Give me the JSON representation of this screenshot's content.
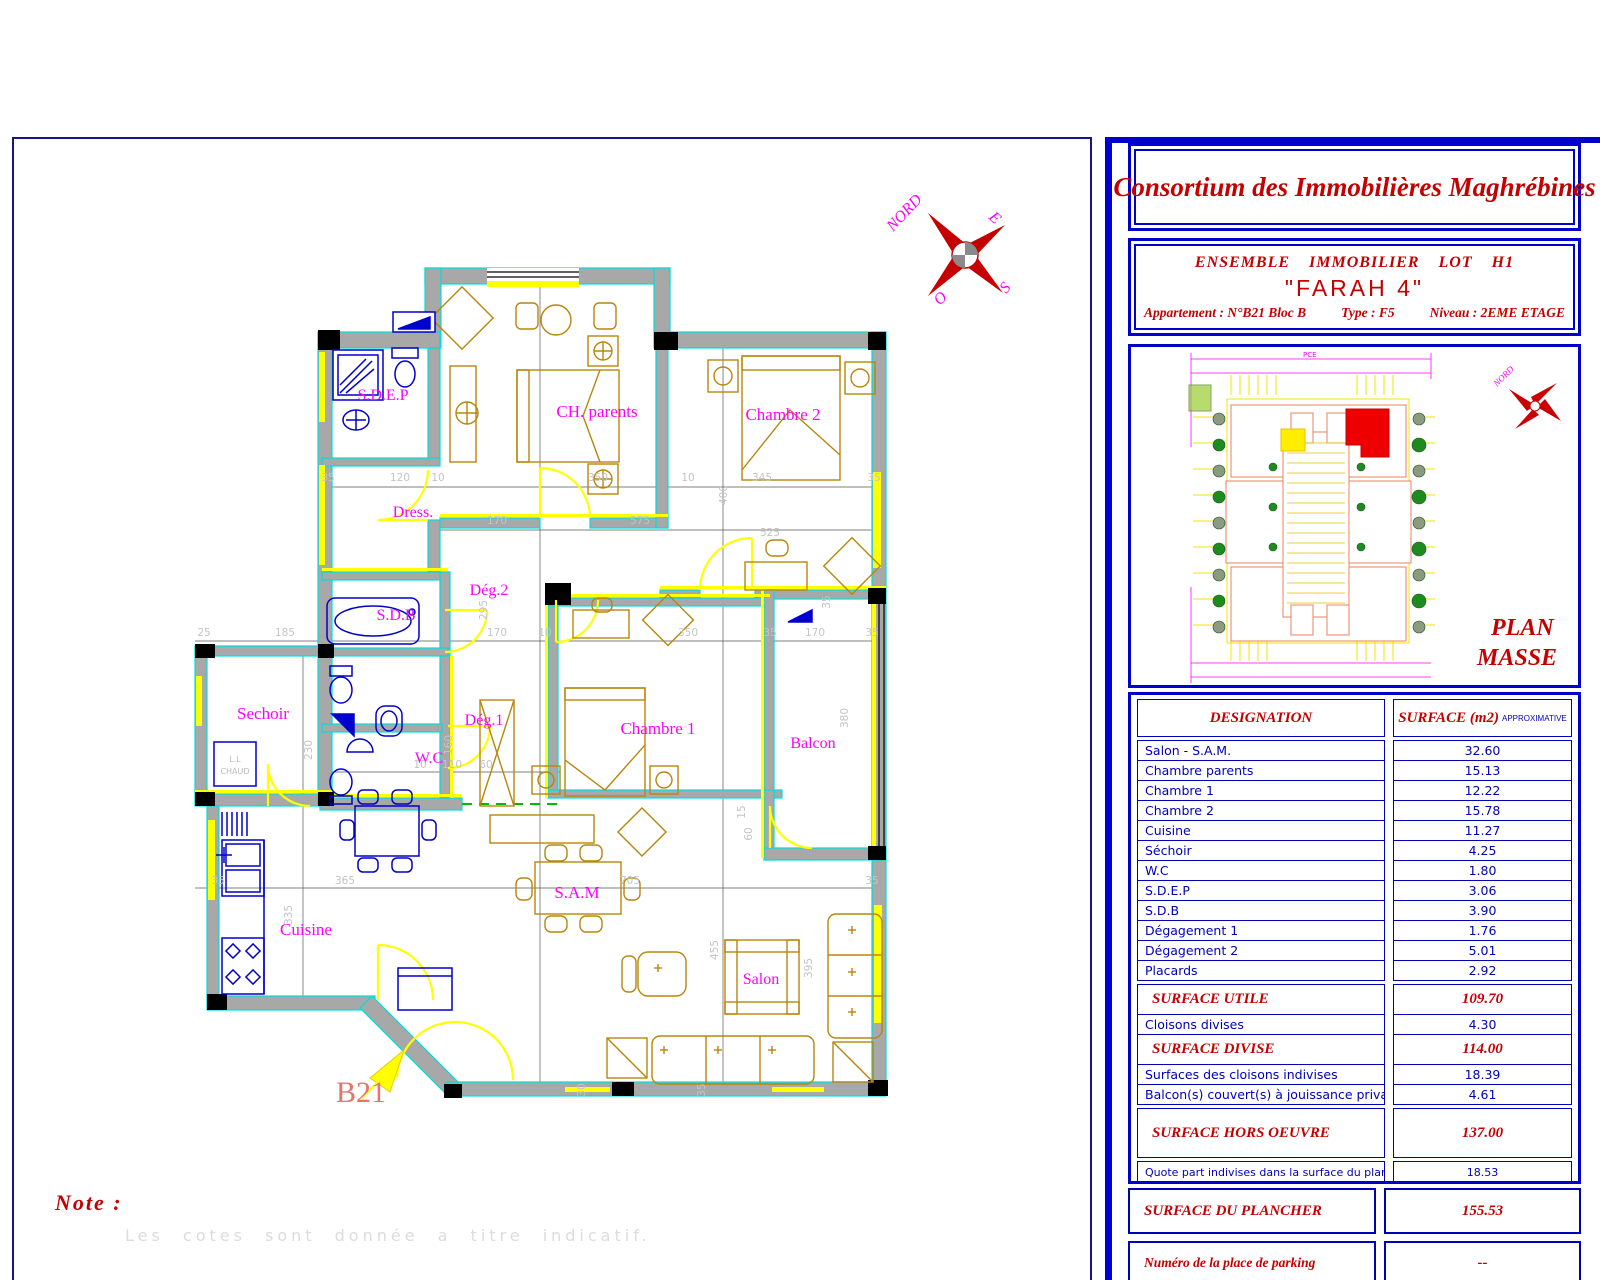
{
  "header": {
    "company": "Consortium des Immobilières Maghrébines"
  },
  "project": {
    "line1": "ENSEMBLE IMMOBILIER LOT H1",
    "name": "\"FARAH 4\"",
    "apartment": "Appartement : N°B21 Bloc B",
    "type": "Type : F5",
    "niveau": "Niveau : 2EME ETAGE"
  },
  "plan_masse": {
    "title_line1": "PLAN",
    "title_line2": "MASSE",
    "compass_label": "NORD",
    "pce_label": "PCE"
  },
  "surface_table": {
    "headers": {
      "designation": "DESIGNATION",
      "surface": "SURFACE  (m2)",
      "approx": "APPROXIMATIVE"
    },
    "rooms": [
      {
        "label": "Salon - S.A.M.",
        "value": "32.60"
      },
      {
        "label": "Chambre parents",
        "value": "15.13"
      },
      {
        "label": "Chambre 1",
        "value": "12.22"
      },
      {
        "label": "Chambre 2",
        "value": "15.78"
      },
      {
        "label": "Cuisine",
        "value": "11.27"
      },
      {
        "label": "Séchoir",
        "value": "4.25"
      },
      {
        "label": "W.C",
        "value": "1.80"
      },
      {
        "label": "S.D.E.P",
        "value": "3.06"
      },
      {
        "label": "S.D.B",
        "value": "3.90"
      },
      {
        "label": "Dégagement 1",
        "value": "1.76"
      },
      {
        "label": "Dégagement 2",
        "value": "5.01"
      },
      {
        "label": "Placards",
        "value": "2.92"
      }
    ],
    "summary": [
      {
        "label": "SURFACE UTILE",
        "value": "109.70",
        "style": "major gap"
      },
      {
        "label": "Cloisons divises",
        "value": "4.30",
        "style": ""
      },
      {
        "label": "SURFACE DIVISE",
        "value": "114.00",
        "style": "major"
      },
      {
        "label": "Surfaces des cloisons indivises",
        "value": "18.39",
        "style": ""
      },
      {
        "label": "Balcon(s) couvert(s) à jouissance privative",
        "value": "4.61",
        "style": ""
      },
      {
        "label": "SURFACE HORS OEUVRE",
        "value": "137.00",
        "style": "major tall gap"
      },
      {
        "label": "Quote part indivises dans la surface du plancher",
        "value": "18.53",
        "style": "small gap"
      }
    ],
    "plancher": {
      "label": "SURFACE DU PLANCHER",
      "value": "155.53"
    },
    "parking": {
      "label": "Numéro de la place de parking",
      "value": "--"
    }
  },
  "note": {
    "title": "Note :",
    "text": "Les cotes sont donnée a titre indicatif."
  },
  "plan": {
    "unit_label": "B21",
    "compass": {
      "n": "NORD",
      "e": "E",
      "s": "S",
      "o": "O"
    },
    "washer_line1": "L.L",
    "washer_line2": "CHAUD",
    "rooms": [
      {
        "t": "S.D.E.P",
        "x": 383,
        "y": 400,
        "fs": 16
      },
      {
        "t": "Dress.",
        "x": 413,
        "y": 517,
        "fs": 16
      },
      {
        "t": "S.D.B",
        "x": 396,
        "y": 620,
        "fs": 16
      },
      {
        "t": "Dég.2",
        "x": 489,
        "y": 595,
        "fs": 16
      },
      {
        "t": "CH. parents",
        "x": 597,
        "y": 417,
        "fs": 17
      },
      {
        "t": "Chambre 2",
        "x": 783,
        "y": 420,
        "fs": 17
      },
      {
        "t": "Sechoir",
        "x": 263,
        "y": 719,
        "fs": 17
      },
      {
        "t": "Dég.1",
        "x": 484,
        "y": 725,
        "fs": 16
      },
      {
        "t": "W.C",
        "x": 429,
        "y": 763,
        "fs": 16
      },
      {
        "t": "Chambre 1",
        "x": 658,
        "y": 734,
        "fs": 17
      },
      {
        "t": "Balcon",
        "x": 813,
        "y": 748,
        "fs": 16
      },
      {
        "t": "S.A.M",
        "x": 577,
        "y": 898,
        "fs": 17
      },
      {
        "t": "Cuisine",
        "x": 306,
        "y": 935,
        "fs": 17
      },
      {
        "t": "Salon",
        "x": 761,
        "y": 984,
        "fs": 16
      }
    ],
    "dims": [
      {
        "t": "35",
        "x": 328,
        "y": 481
      },
      {
        "t": "120",
        "x": 400,
        "y": 481
      },
      {
        "t": "10",
        "x": 438,
        "y": 481
      },
      {
        "t": "350",
        "x": 598,
        "y": 481
      },
      {
        "t": "10",
        "x": 688,
        "y": 481
      },
      {
        "t": "345",
        "x": 762,
        "y": 481
      },
      {
        "t": "35",
        "x": 874,
        "y": 481
      },
      {
        "t": "170",
        "x": 497,
        "y": 524
      },
      {
        "t": "575",
        "x": 640,
        "y": 524
      },
      {
        "t": "525",
        "x": 770,
        "y": 536
      },
      {
        "t": "25",
        "x": 204,
        "y": 636
      },
      {
        "t": "185",
        "x": 285,
        "y": 636
      },
      {
        "t": "170",
        "x": 497,
        "y": 636
      },
      {
        "t": "10",
        "x": 545,
        "y": 636
      },
      {
        "t": "350",
        "x": 688,
        "y": 636
      },
      {
        "t": "35",
        "x": 770,
        "y": 636
      },
      {
        "t": "170",
        "x": 815,
        "y": 636
      },
      {
        "t": "35",
        "x": 872,
        "y": 636
      },
      {
        "t": "10",
        "x": 420,
        "y": 768
      },
      {
        "t": "110",
        "x": 452,
        "y": 768
      },
      {
        "t": "60",
        "x": 486,
        "y": 768
      },
      {
        "t": "35",
        "x": 218,
        "y": 884
      },
      {
        "t": "365",
        "x": 345,
        "y": 884
      },
      {
        "t": "705",
        "x": 630,
        "y": 884
      },
      {
        "t": "35",
        "x": 872,
        "y": 884
      },
      {
        "t": "295",
        "x": 487,
        "y": 610,
        "r": 1
      },
      {
        "t": "400",
        "x": 727,
        "y": 495,
        "r": 1
      },
      {
        "t": "230",
        "x": 312,
        "y": 750,
        "r": 1
      },
      {
        "t": "160",
        "x": 452,
        "y": 745,
        "r": 1
      },
      {
        "t": "335",
        "x": 292,
        "y": 915,
        "r": 1
      },
      {
        "t": "455",
        "x": 718,
        "y": 950,
        "r": 1
      },
      {
        "t": "395",
        "x": 812,
        "y": 968,
        "r": 1
      },
      {
        "t": "380",
        "x": 848,
        "y": 718,
        "r": 1
      },
      {
        "t": "60",
        "x": 752,
        "y": 834,
        "r": 1
      },
      {
        "t": "30",
        "x": 585,
        "y": 1090,
        "r": 1
      },
      {
        "t": "35",
        "x": 705,
        "y": 1090,
        "r": 1
      },
      {
        "t": "35",
        "x": 830,
        "y": 602,
        "r": 1
      },
      {
        "t": "15",
        "x": 745,
        "y": 812,
        "r": 1
      }
    ]
  }
}
